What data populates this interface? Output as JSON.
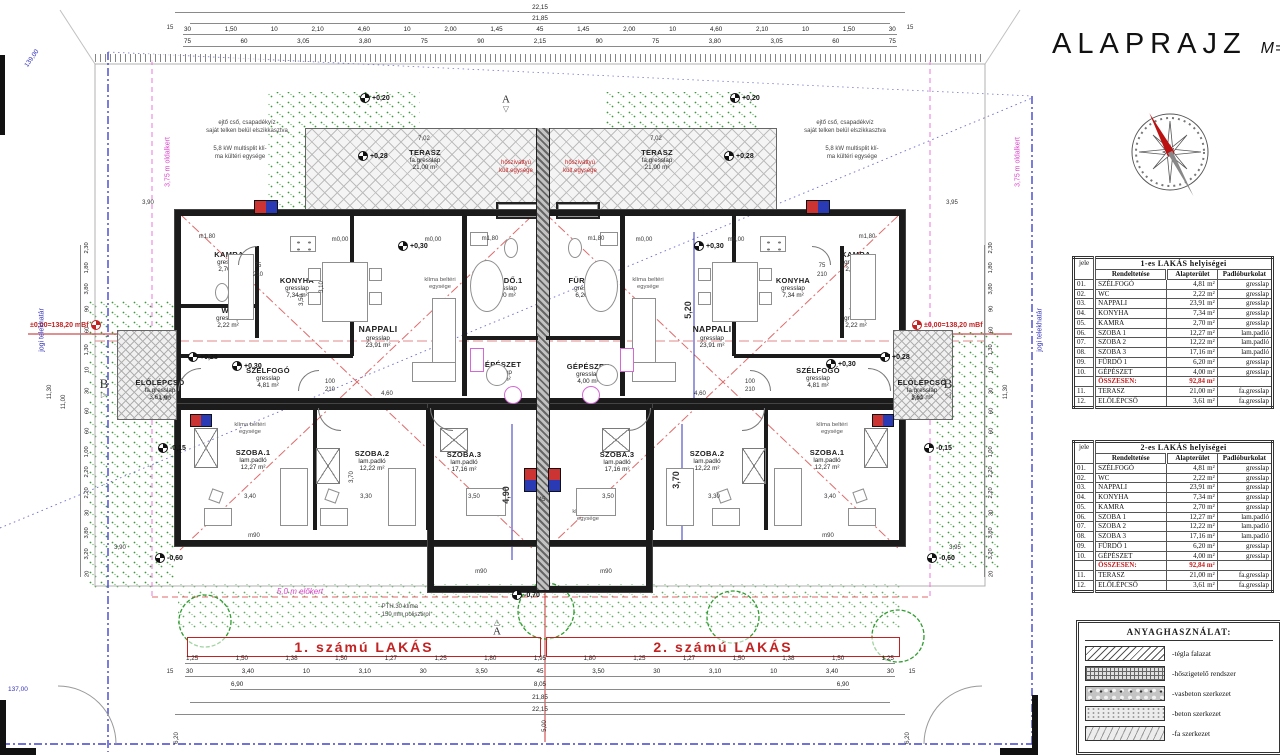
{
  "title": {
    "main": "ALAPRAJZ",
    "scale": "M=1:100"
  },
  "tables": [
    {
      "title": "1-es LAKÁS helyiségei",
      "jele": "jele",
      "cols": [
        "Rendeltetése",
        "Alapterület",
        "Padlóburkolat"
      ],
      "rows": [
        [
          "01.",
          "SZÉLFOGÓ",
          "4,81 m²",
          "gresslap"
        ],
        [
          "02.",
          "WC",
          "2,22 m²",
          "gresslap"
        ],
        [
          "03.",
          "NAPPALI",
          "23,91 m²",
          "gresslap"
        ],
        [
          "04.",
          "KONYHA",
          "7,34 m²",
          "gresslap"
        ],
        [
          "05.",
          "KAMRA",
          "2,70 m²",
          "gresslap"
        ],
        [
          "06.",
          "SZOBA 1",
          "12,27 m²",
          "lam.padló"
        ],
        [
          "07.",
          "SZOBA 2",
          "12,22 m²",
          "lam.padló"
        ],
        [
          "08.",
          "SZOBA 3",
          "17,16 m²",
          "lam.padló"
        ],
        [
          "09.",
          "FÜRDŐ 1",
          "6,20 m²",
          "gresslap"
        ],
        [
          "10.",
          "GÉPÉSZET",
          "4,00 m²",
          "gresslap"
        ],
        [
          "",
          "ÖSSZESEN:",
          "92,84 m²",
          ""
        ],
        [
          "11.",
          "TERASZ",
          "21,00 m²",
          "fa.gresslap"
        ],
        [
          "12.",
          "ELŐLÉPCSŐ",
          "3,61 m²",
          "fa.gresslap"
        ]
      ]
    },
    {
      "title": "2-es LAKÁS helyiségei",
      "jele": "jele",
      "cols": [
        "Rendeltetése",
        "Alapterület",
        "Padlóburkolat"
      ],
      "rows": [
        [
          "01.",
          "SZÉLFOGÓ",
          "4,81 m²",
          "gresslap"
        ],
        [
          "02.",
          "WC",
          "2,22 m²",
          "gresslap"
        ],
        [
          "03.",
          "NAPPALI",
          "23,91 m²",
          "gresslap"
        ],
        [
          "04.",
          "KONYHA",
          "7,34 m²",
          "gresslap"
        ],
        [
          "05.",
          "KAMRA",
          "2,70 m²",
          "gresslap"
        ],
        [
          "06.",
          "SZOBA 1",
          "12,27 m²",
          "lam.padló"
        ],
        [
          "07.",
          "SZOBA 2",
          "12,22 m²",
          "lam.padló"
        ],
        [
          "08.",
          "SZOBA 3",
          "17,16 m²",
          "lam.padló"
        ],
        [
          "09.",
          "FÜRDŐ 1",
          "6,20 m²",
          "gresslap"
        ],
        [
          "10.",
          "GÉPÉSZET",
          "4,00 m²",
          "gresslap"
        ],
        [
          "",
          "ÖSSZESEN:",
          "92,84 m²",
          ""
        ],
        [
          "11.",
          "TERASZ",
          "21,00 m²",
          "fa.gresslap"
        ],
        [
          "12.",
          "ELŐLÉPCSŐ",
          "3,61 m²",
          "fa.gresslap"
        ]
      ]
    }
  ],
  "legend": {
    "title": "ANYAGHASZNÁLAT:",
    "items": [
      {
        "label": "-tégla falazat",
        "pattern": "brick"
      },
      {
        "label": "-hőszigetelő rendszer",
        "pattern": "insul"
      },
      {
        "label": "-vasbeton szerkezet",
        "pattern": "rc"
      },
      {
        "label": "-beton szerkezet",
        "pattern": "conc"
      },
      {
        "label": "-fa szerkezet",
        "pattern": "wood"
      }
    ]
  },
  "plan": {
    "apartments": {
      "left": "1. számú LAKÁS",
      "right": "2. számú LAKÁS"
    },
    "rooms": {
      "szelfogo": {
        "name": "SZÉLFOGÓ",
        "floor": "gresslap",
        "area": "4,81 m²"
      },
      "wc": {
        "name": "WC",
        "floor": "gresslap",
        "area": "2,22 m²"
      },
      "nappali": {
        "name": "NAPPALI",
        "floor": "gresslap",
        "area": "23,91 m²"
      },
      "konyha": {
        "name": "KONYHA",
        "floor": "gresslap",
        "area": "7,34 m²"
      },
      "kamra": {
        "name": "KAMRA",
        "floor": "gresslap",
        "area": "2,70 m²"
      },
      "szoba1": {
        "name": "SZOBA.1",
        "floor": "lam.padló",
        "area": "12,27 m²"
      },
      "szoba2": {
        "name": "SZOBA.2",
        "floor": "lam.padló",
        "area": "12,22 m²"
      },
      "szoba3": {
        "name": "SZOBA.3",
        "floor": "lam.padló",
        "area": "17,16 m²"
      },
      "furdo": {
        "name": "FÜRDŐ.1",
        "floor": "gresslap",
        "area": "6,20 m²"
      },
      "gepeszet": {
        "name": "GÉPÉSZET",
        "floor": "gresslap",
        "area": "4,00 m²"
      },
      "terasz": {
        "name": "TERASZ",
        "floor": "fa.gresslap",
        "area": "21,00 m²"
      },
      "elolepcso": {
        "name": "ELŐLÉPCSŐ",
        "floor": "fa.gresslap",
        "area": "3,61 m²"
      }
    },
    "levels": {
      "p020": "+0,20",
      "p028": "+0,28",
      "p030": "+0,30",
      "zero": "±0,00=138,20 mBf",
      "m015": "-0,15",
      "m060": "-0,60",
      "m070": "-0,70"
    },
    "marks": {
      "m180": "m1,80",
      "m000": "m0,00",
      "m90": "m90",
      "a": "A",
      "b": "B"
    },
    "annotations": {
      "downpipe1": "ejtő cső, csapadékvíz",
      "downpipe2": "saját telken belül elszikkasztva",
      "multisplit1": "5,8 kW multisplit klí-",
      "multisplit2": "ma kültéri egysége",
      "heatpump1": "hőszivattyú",
      "heatpump2": "kült.egysége",
      "klima1": "klíma beltéri",
      "klima2": "egysége",
      "pth": "- PTH.30 klíma",
      "poli": "- 150 mm polisztirol",
      "elokert": "5,0 m előkert",
      "oldalkert": "3,75 m oldalkert",
      "telekhatar": "jogi telekhatár",
      "lev139": "139,00",
      "lev137": "137,00"
    },
    "dims": {
      "top_total": "22,15",
      "top_sub": "21,85",
      "corner": "15",
      "top1": [
        "30",
        "1,50",
        "10",
        "2,10",
        "4,60",
        "10",
        "2,00",
        "1,45",
        "45",
        "1,45",
        "2,00",
        "10",
        "4,60",
        "2,10",
        "10",
        "1,50",
        "30"
      ],
      "top2": [
        "75",
        "60",
        "3,05",
        "3,80",
        "75",
        "90",
        "2,15",
        "90",
        "75",
        "3,80",
        "3,05",
        "60",
        "75"
      ],
      "bottom1": [
        "1,25",
        "1,50",
        "1,38",
        "1,50",
        "1,27",
        "1,25",
        "1,80",
        "1,95",
        "1,80",
        "1,25",
        "1,27",
        "1,50",
        "1,38",
        "1,50",
        "1,25"
      ],
      "bottom2": [
        "30",
        "3,40",
        "10",
        "3,10",
        "30",
        "3,50",
        "45",
        "3,50",
        "30",
        "3,10",
        "10",
        "3,40",
        "30"
      ],
      "bottom3": [
        "6,90",
        "8,05",
        "6,90"
      ],
      "bottom_sub": "21,85",
      "bottom_total": "22,15",
      "leftcol": [
        "2,30",
        "1,80",
        "3,80",
        "90",
        "60",
        "1,30",
        "10",
        "30",
        "60",
        "60",
        "1,00",
        "2,20",
        "2,20",
        "30",
        "3,80",
        "3,20",
        "20"
      ],
      "rightcol": [
        "2,30",
        "1,80",
        "3,80",
        "90",
        "60",
        "1,30",
        "10",
        "30",
        "60",
        "60",
        "1,00",
        "2,20",
        "2,20",
        "30",
        "3,80",
        "3,20",
        "20"
      ],
      "left_total": "11,30",
      "right_total": "11,00",
      "terasz_w": "7,02",
      "gap10": "10",
      "blue_a": "5,20",
      "blue_b": "4,90",
      "blue_c": "3,70",
      "red_a": "3,90",
      "red_b": "3,95",
      "red_c": "5,00",
      "red_d": "6,20",
      "s340": "3,40",
      "s330": "3,30",
      "s350": "3,50",
      "v370": "3,70",
      "v310": "3,10",
      "v350": "3,50",
      "d460": "4,60",
      "d190": "1,90",
      "d100": "100",
      "d210": "210",
      "d75": "75",
      "d45": "45"
    }
  }
}
